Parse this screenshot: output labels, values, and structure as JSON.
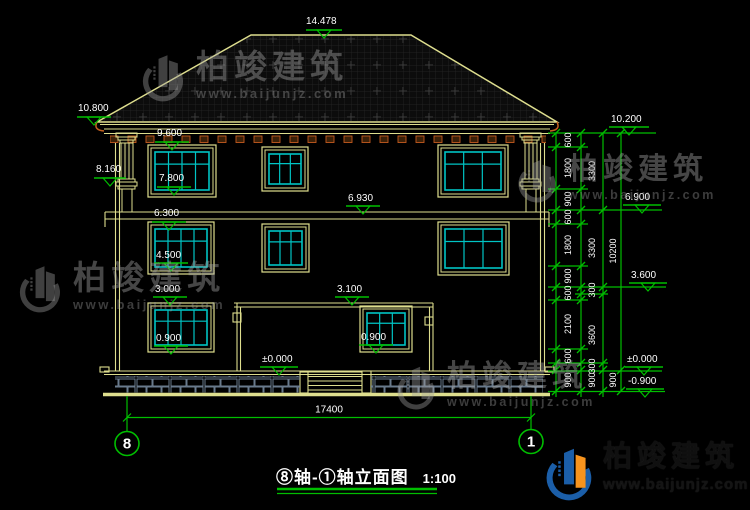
{
  "drawing": {
    "title": "⑧轴-①轴立面图",
    "scale": "1:100",
    "total_width": "17400",
    "axis_left": "8",
    "axis_right": "1"
  },
  "levels": {
    "ridge": "14.478",
    "left_eave": "10.800",
    "pilaster_base": "8.160",
    "f3_win_top": "9.600",
    "f3_win_sill": "7.800",
    "f2_slab": "6.930",
    "f2_win_top": "6.300",
    "f2_win_sill": "4.500",
    "f1_win_top": "3.000",
    "porch_roof": "3.100",
    "f1_win_sill": "0.900",
    "porch_win_sill": "0.900",
    "entry_ground": "±0.000",
    "r_parapet": "10.200",
    "r_f3": "6.900",
    "r_f2": "3.600",
    "r_ground": "±0.000",
    "r_site": "-0.900"
  },
  "dims": {
    "col1": [
      "600",
      "1800",
      "900",
      "600",
      "1800",
      "900",
      "600",
      "2100",
      "600",
      "900"
    ],
    "col2": [
      "3300",
      "3300",
      "300",
      "3600",
      "300",
      "900"
    ],
    "col3": [
      "10200",
      "900"
    ]
  },
  "watermark": {
    "name": "柏竣建筑",
    "url": "www.baijunjz.com"
  },
  "logo": {
    "name": "柏竣建筑",
    "url": "www.baijunjz.com"
  }
}
